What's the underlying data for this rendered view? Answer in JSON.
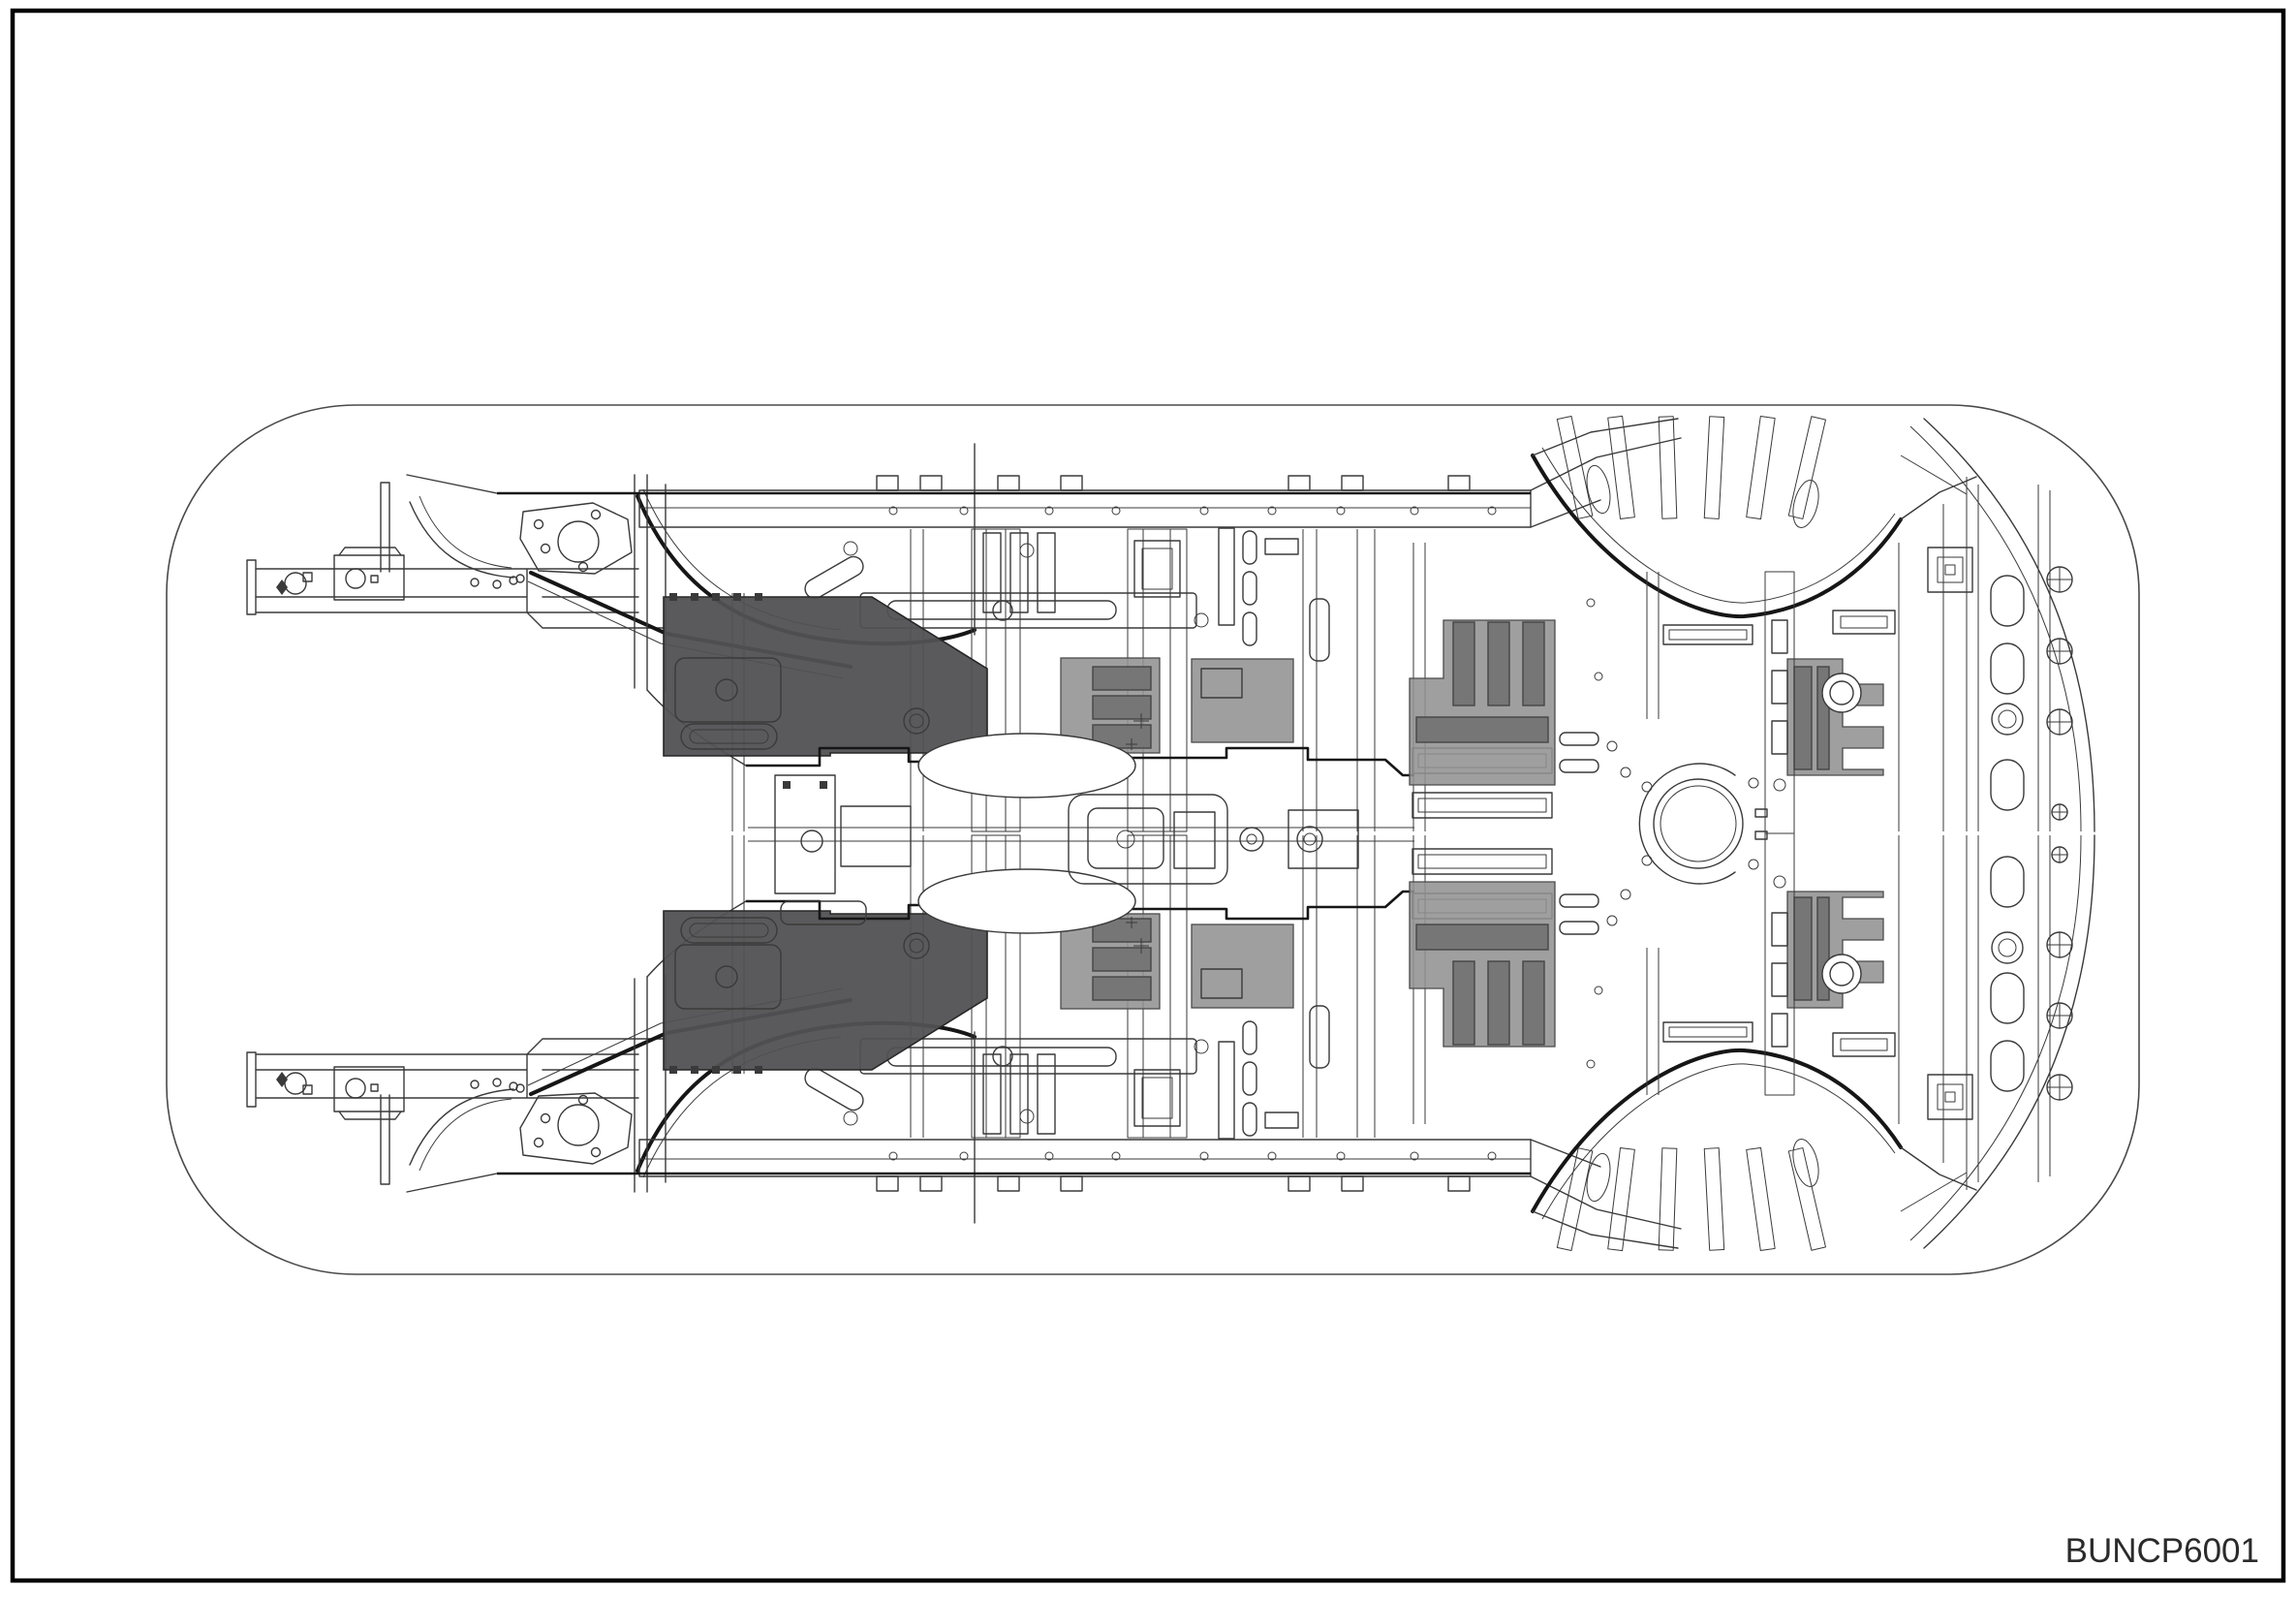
{
  "page": {
    "figure_code": "BUNCP6001",
    "background": "#ffffff",
    "border_color": "#000000",
    "code_color": "#2b2b2b"
  },
  "diagram": {
    "subject": "vehicle-underbody-structure-top-view",
    "line_color": "#3a3a3a",
    "thick_line_color": "#161616",
    "pad_color_dark": "#515153",
    "pad_color_light": "#929292",
    "pad_rib_color": "#767676"
  }
}
